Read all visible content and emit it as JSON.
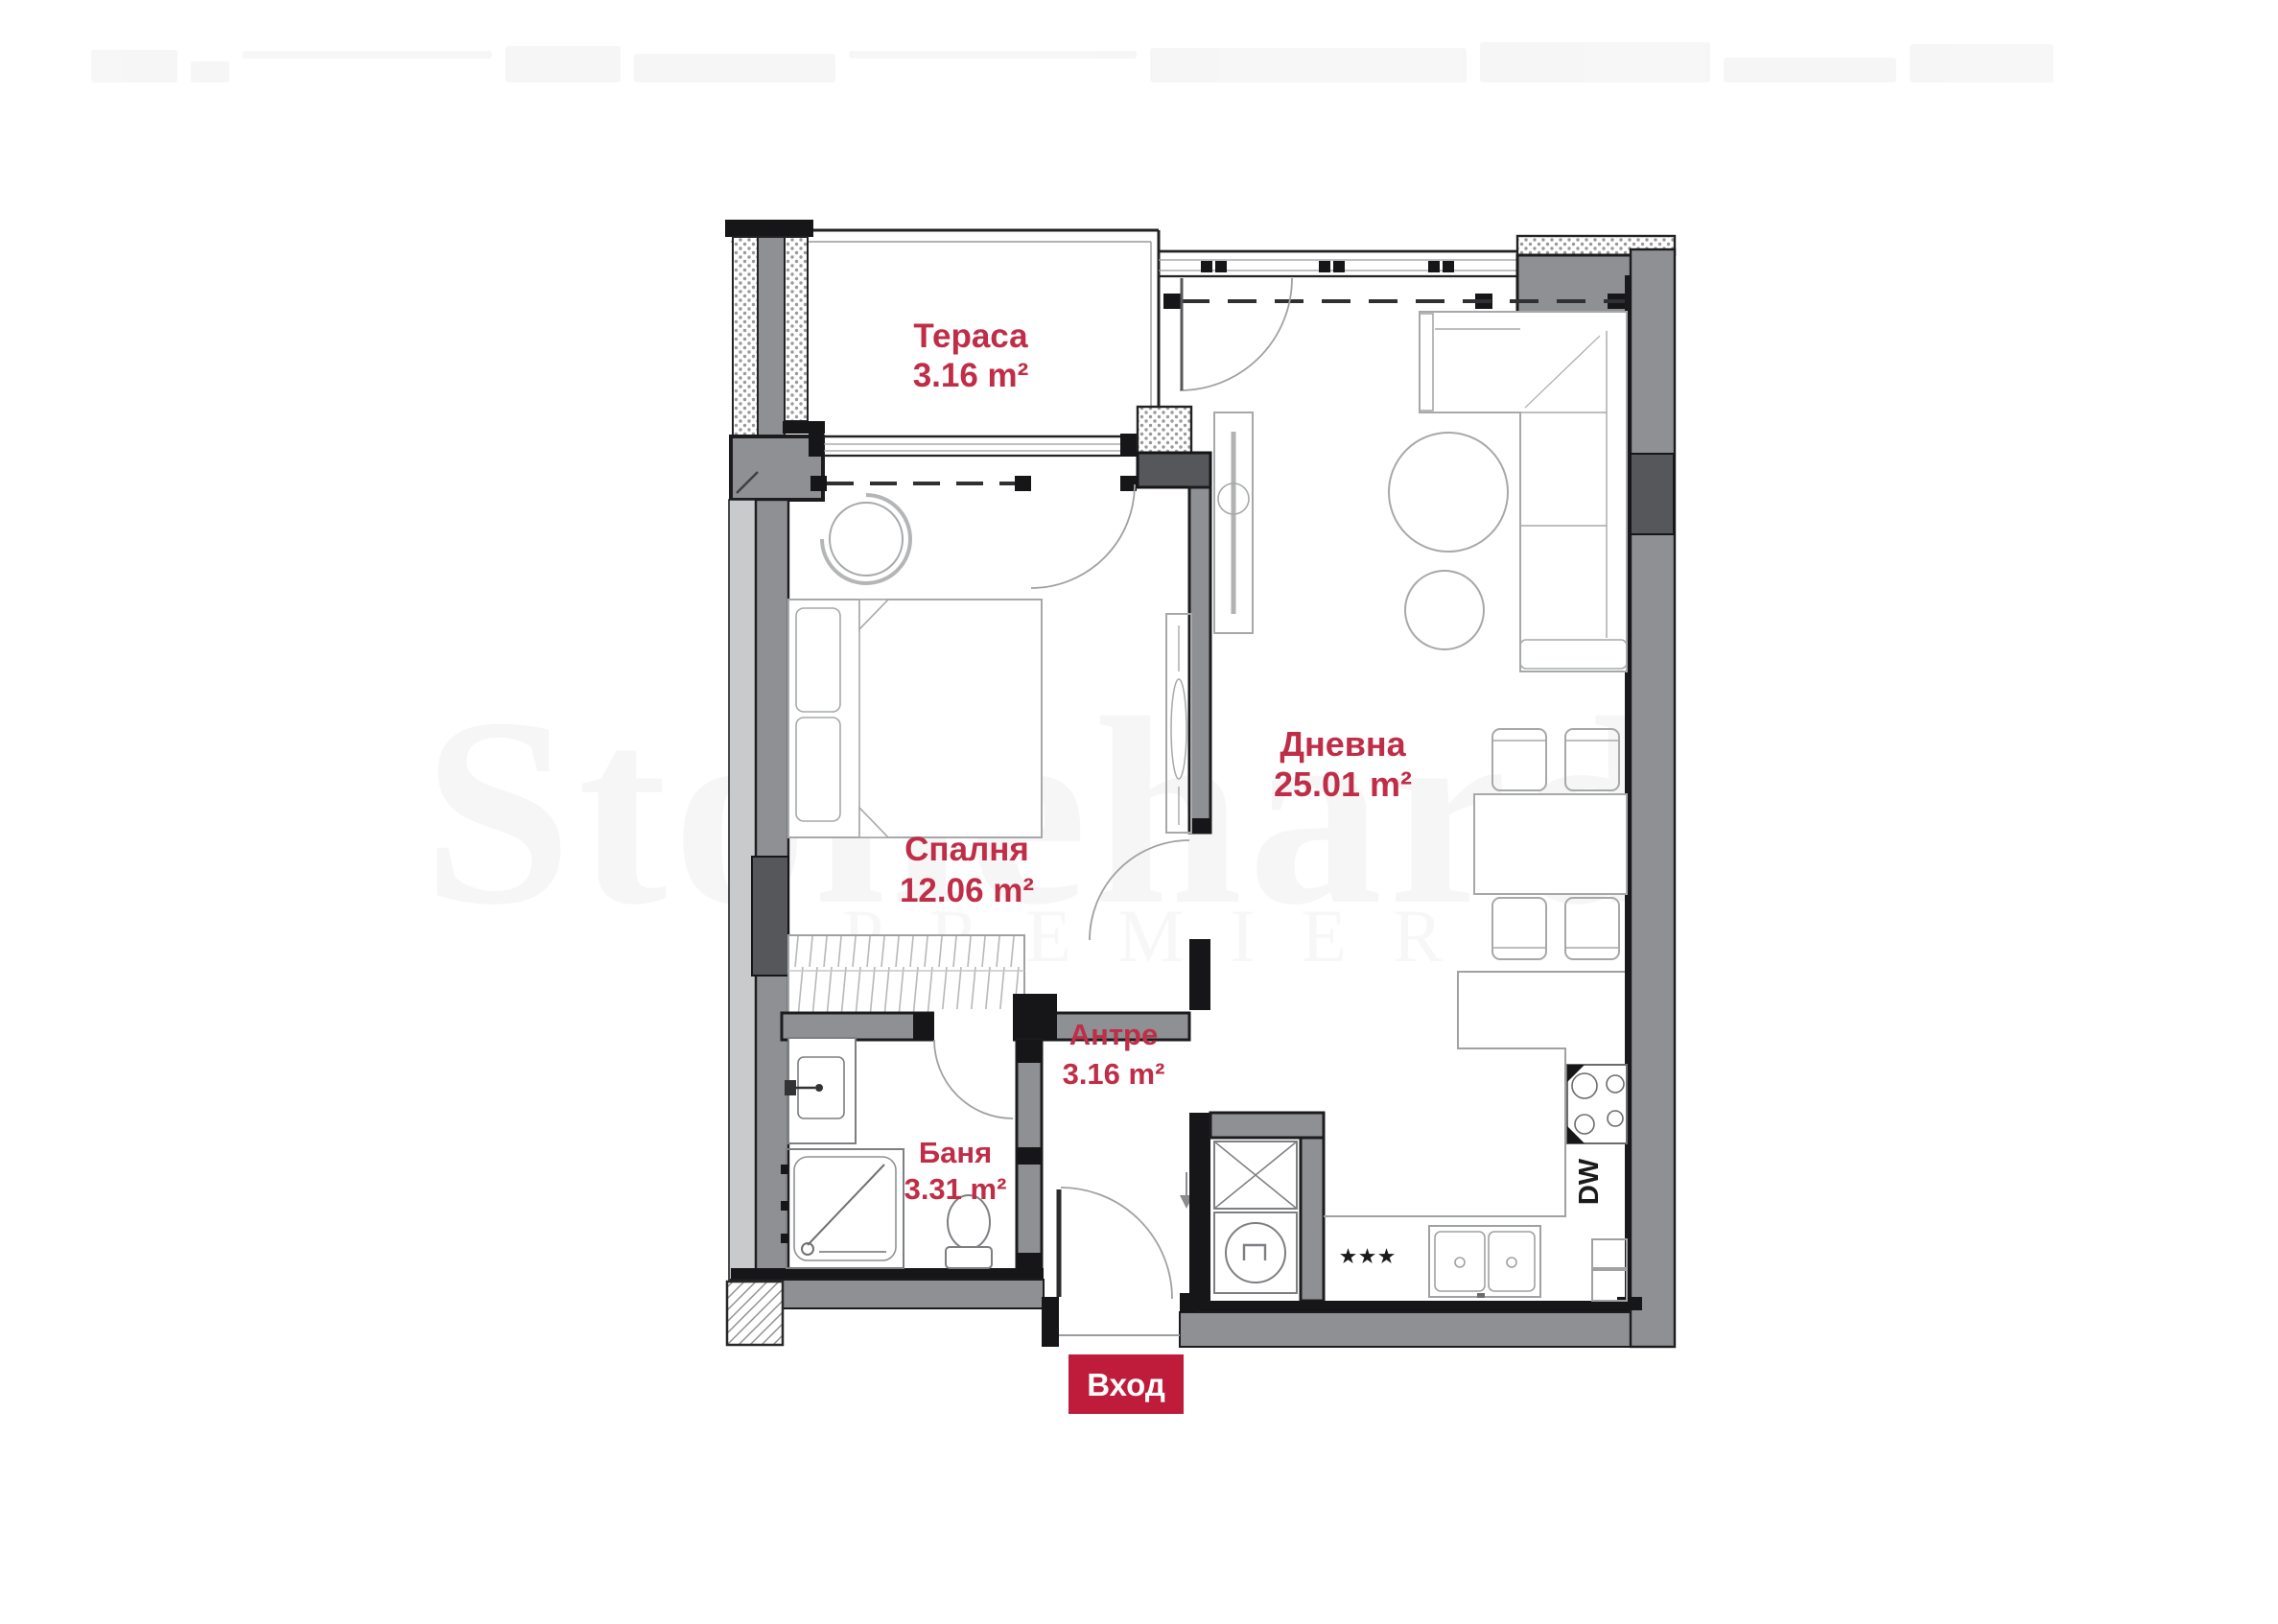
{
  "floorplan": {
    "entrance_badge": "Вход",
    "rooms": {
      "terrace": {
        "name": "Тераса",
        "area": "3.16 m²"
      },
      "living": {
        "name": "Дневна",
        "area": "25.01 m²"
      },
      "bedroom": {
        "name": "Спалня",
        "area": "12.06 m²"
      },
      "hallway": {
        "name": "Антре",
        "area": "3.16 m²"
      },
      "bathroom": {
        "name": "Баня",
        "area": "3.31 m²"
      }
    },
    "annotations": {
      "dishwasher": "DW",
      "stars": "★★★"
    },
    "watermark": {
      "line1": "Stonehard",
      "line2": "PREMIER"
    },
    "colors": {
      "label_red": "#bf2d47",
      "badge_red": "#bf1c3c",
      "wall_gray": "#8e9093",
      "wall_light": "#c9cacc",
      "wall_dark_block": "#55575a",
      "line_black": "#19191b",
      "furniture_gray": "#a6a8aa"
    }
  }
}
